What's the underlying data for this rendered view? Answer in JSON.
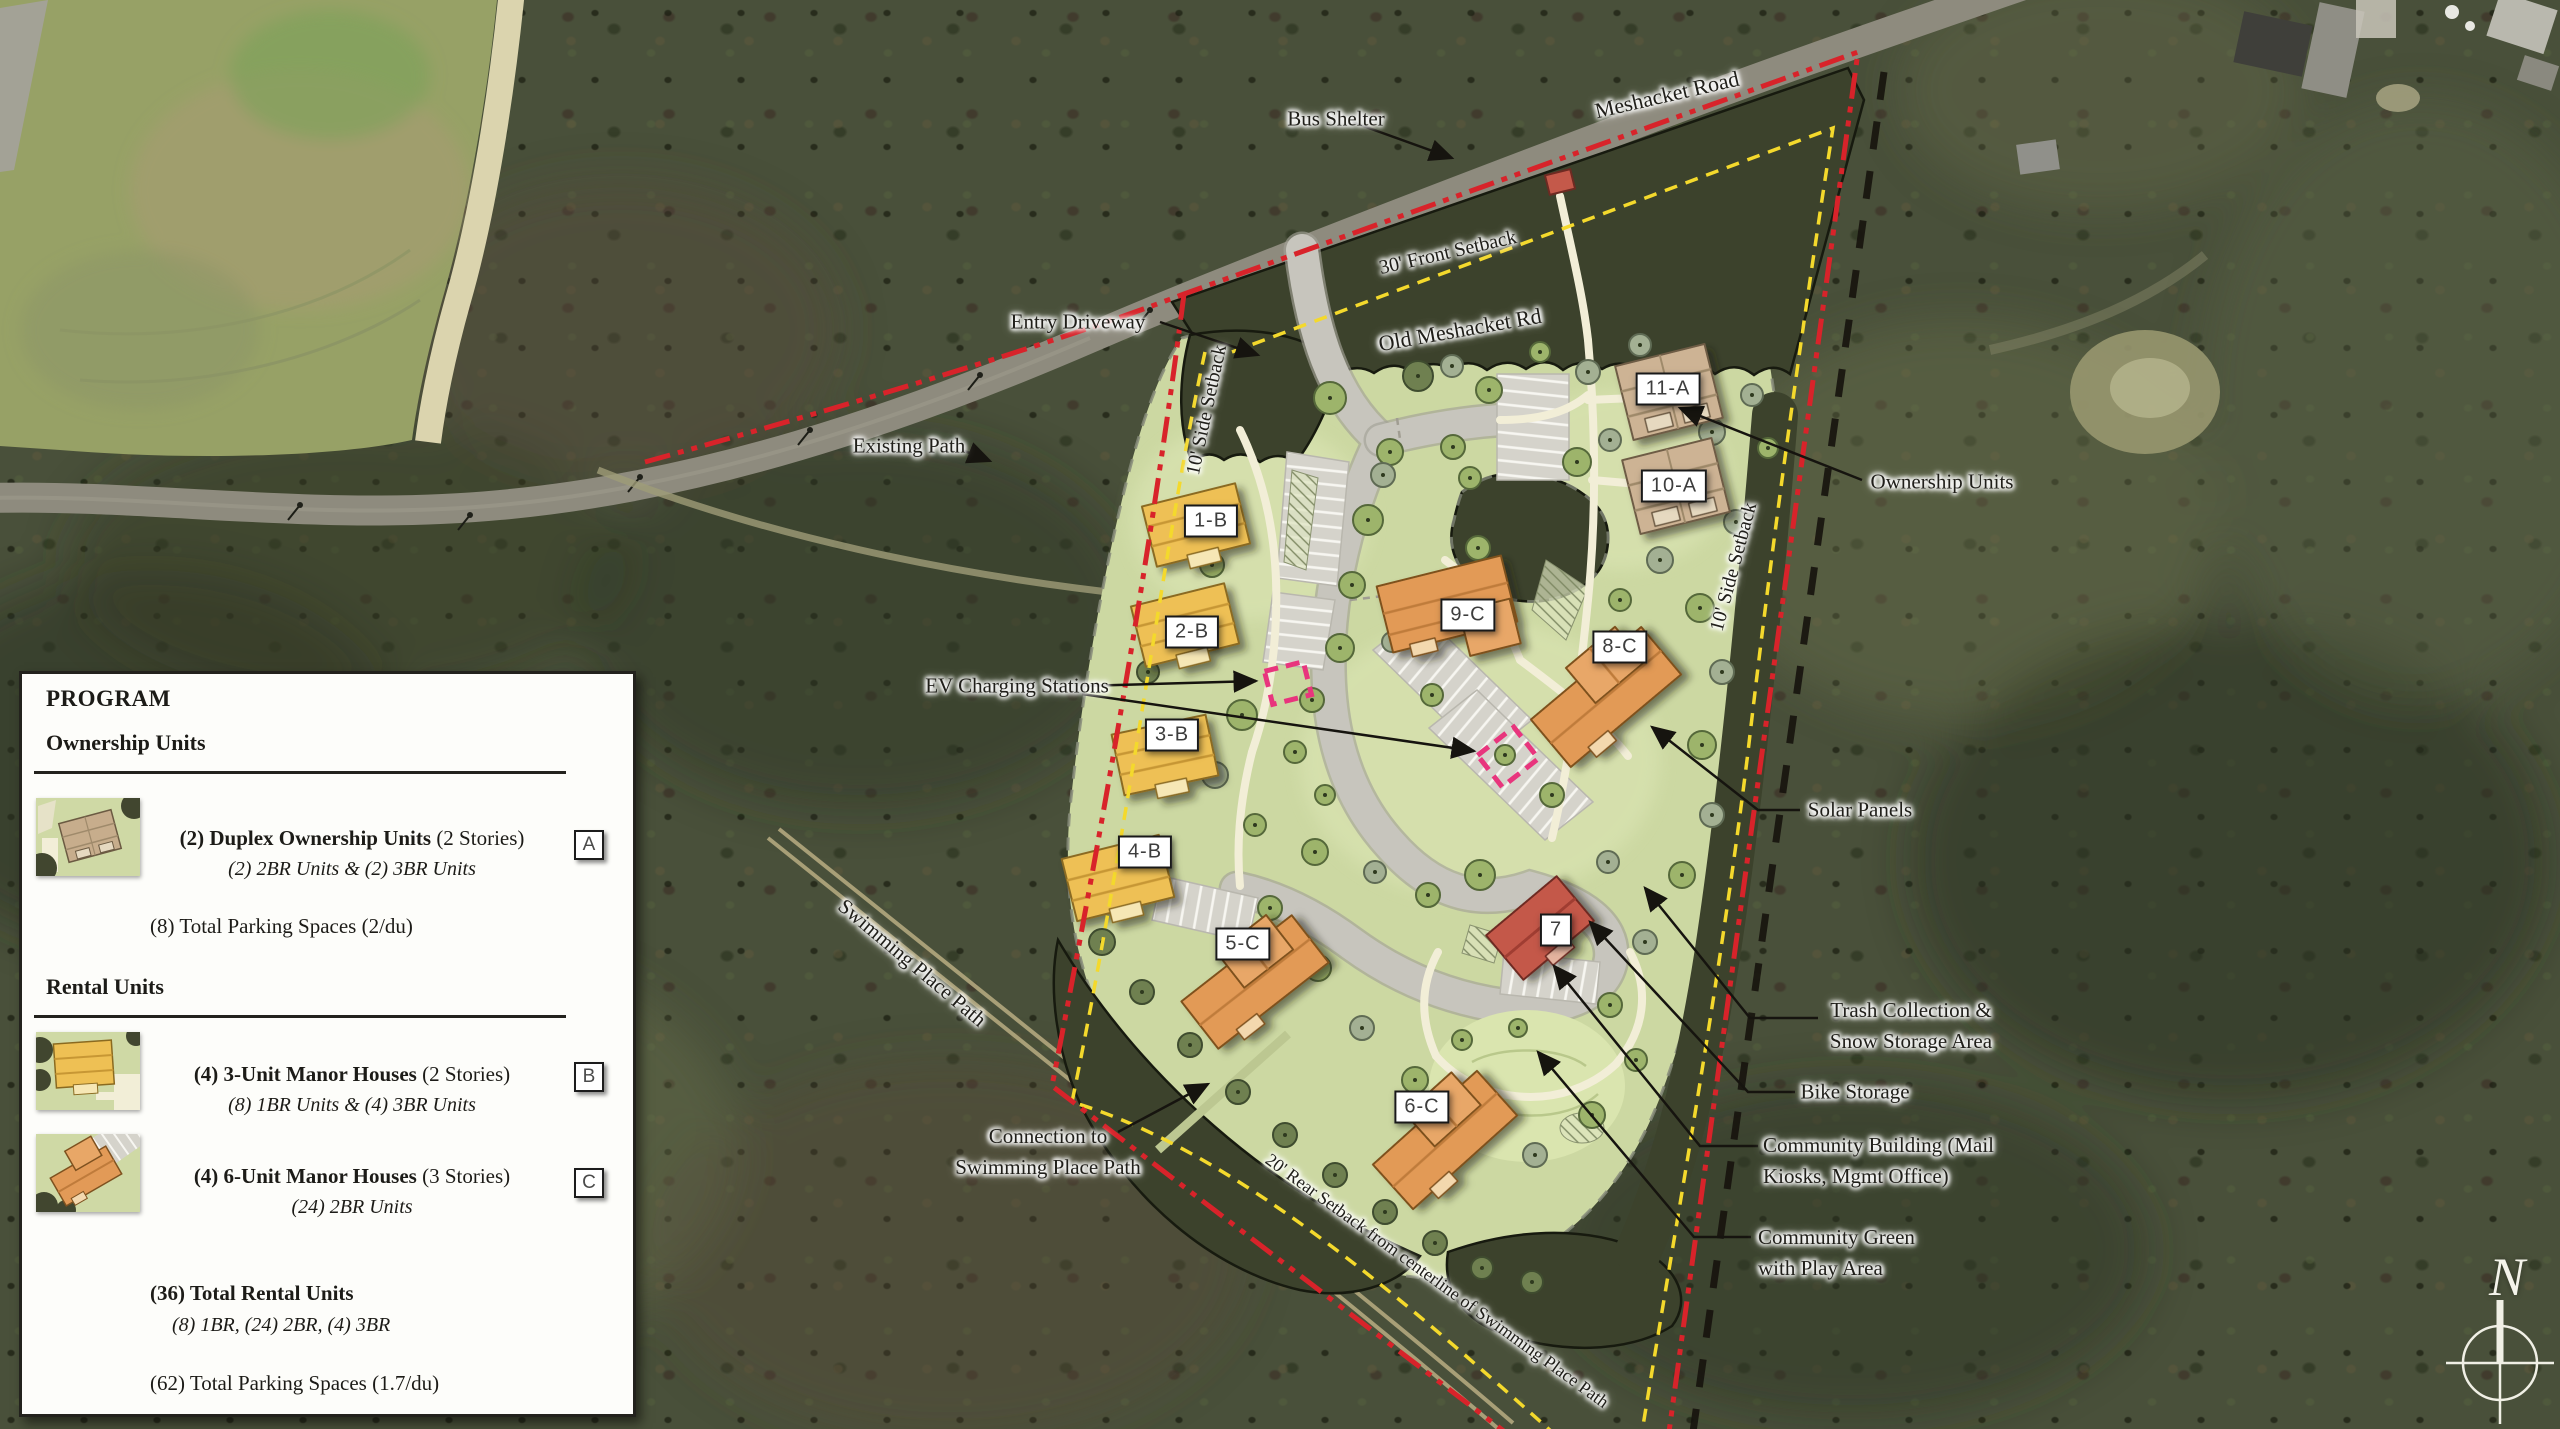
{
  "program": {
    "title": "PROGRAM",
    "ownership_heading": "Ownership Units",
    "rental_heading": "Rental Units",
    "rows": [
      {
        "tag": "A",
        "bold": "(2) Duplex Ownership Units",
        "rest": " (2 Stories)",
        "italic": "(2) 2BR Units & (2) 3BR Units"
      },
      {
        "tag": "B",
        "bold": "(4) 3-Unit Manor Houses",
        "rest": " (2 Stories)",
        "italic": "(8) 1BR Units & (4) 3BR Units"
      },
      {
        "tag": "C",
        "bold": "(4) 6-Unit Manor Houses",
        "rest": " (3 Stories)",
        "italic": "(24) 2BR Units"
      }
    ],
    "ownership_parking": "(8) Total Parking Spaces (2/du)",
    "rental_total_bold": "(36) Total Rental Units",
    "rental_total_italic": "(8) 1BR, (24) 2BR, (4) 3BR",
    "rental_parking": "(62) Total Parking Spaces (1.7/du)"
  },
  "map_labels": {
    "bus_shelter": "Bus Shelter",
    "meshacket_road": "Meshacket Road",
    "front_setback": "30' Front Setback",
    "old_meshacket_rd": "Old Meshacket Rd",
    "entry_driveway": "Entry Driveway",
    "side_setback_left": "10' Side Setback",
    "side_setback_right": "10' Side Setback",
    "existing_path": "Existing Path",
    "ownership_units": "Ownership Units",
    "ev_charging": "EV Charging Stations",
    "solar_panels": "Solar Panels",
    "trash_line1": "Trash Collection &",
    "trash_line2": "Snow Storage Area",
    "bike_storage": "Bike Storage",
    "community_building_line1": "Community Building (Mail",
    "community_building_line2": "Kiosks, Mgmt Office)",
    "community_green_line1": "Community Green",
    "community_green_line2": "with Play Area",
    "connection_line1": "Connection to",
    "connection_line2": "Swimming Place Path",
    "swimming_place_path": "Swimming Place Path",
    "rear_setback": "20' Rear Setback from centerline of Swimming Place Path",
    "compass_north": "N"
  },
  "buildings": [
    {
      "id": "1-B"
    },
    {
      "id": "2-B"
    },
    {
      "id": "3-B"
    },
    {
      "id": "4-B"
    },
    {
      "id": "5-C"
    },
    {
      "id": "6-C"
    },
    {
      "id": "7"
    },
    {
      "id": "8-C"
    },
    {
      "id": "9-C"
    },
    {
      "id": "10-A"
    },
    {
      "id": "11-A"
    }
  ],
  "colors": {
    "property_line": "#d8232a",
    "setback_line": "#f4d92c",
    "ev_marker": "#e8357d"
  }
}
